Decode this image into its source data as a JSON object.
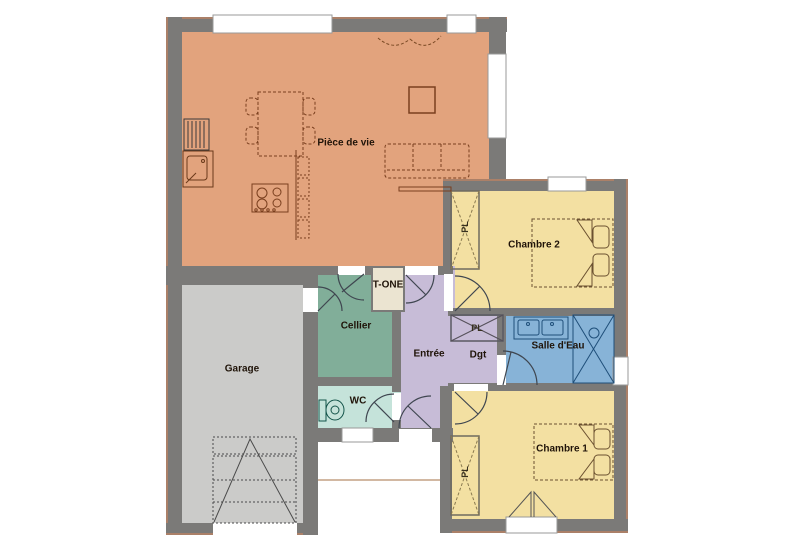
{
  "plan": {
    "type": "house-floor-plan",
    "rooms": {
      "piece_de_vie": {
        "label": "Pièce de vie",
        "color": "#e2a37d"
      },
      "chambre_2": {
        "label": "Chambre 2",
        "color": "#f3e0a2"
      },
      "garage": {
        "label": "Garage",
        "color": "#cbcbc9"
      },
      "cellier": {
        "label": "Cellier",
        "color": "#81ae99"
      },
      "t_one": {
        "label": "T-ONE",
        "color": "#ebe4d1"
      },
      "entree": {
        "label": "Entrée",
        "color": "#c7bcd7"
      },
      "dgt": {
        "label": "Dgt",
        "color": "#c7bcd7"
      },
      "salle_eau": {
        "label": "Salle d'Eau",
        "color": "#87b3d7"
      },
      "wc": {
        "label": "WC",
        "color": "#c5e3da"
      },
      "chambre_1": {
        "label": "Chambre 1",
        "color": "#f3e0a2"
      }
    },
    "closet_label": "PL",
    "wall_color": "#7b7a78",
    "outline_color": "#ab8068"
  }
}
